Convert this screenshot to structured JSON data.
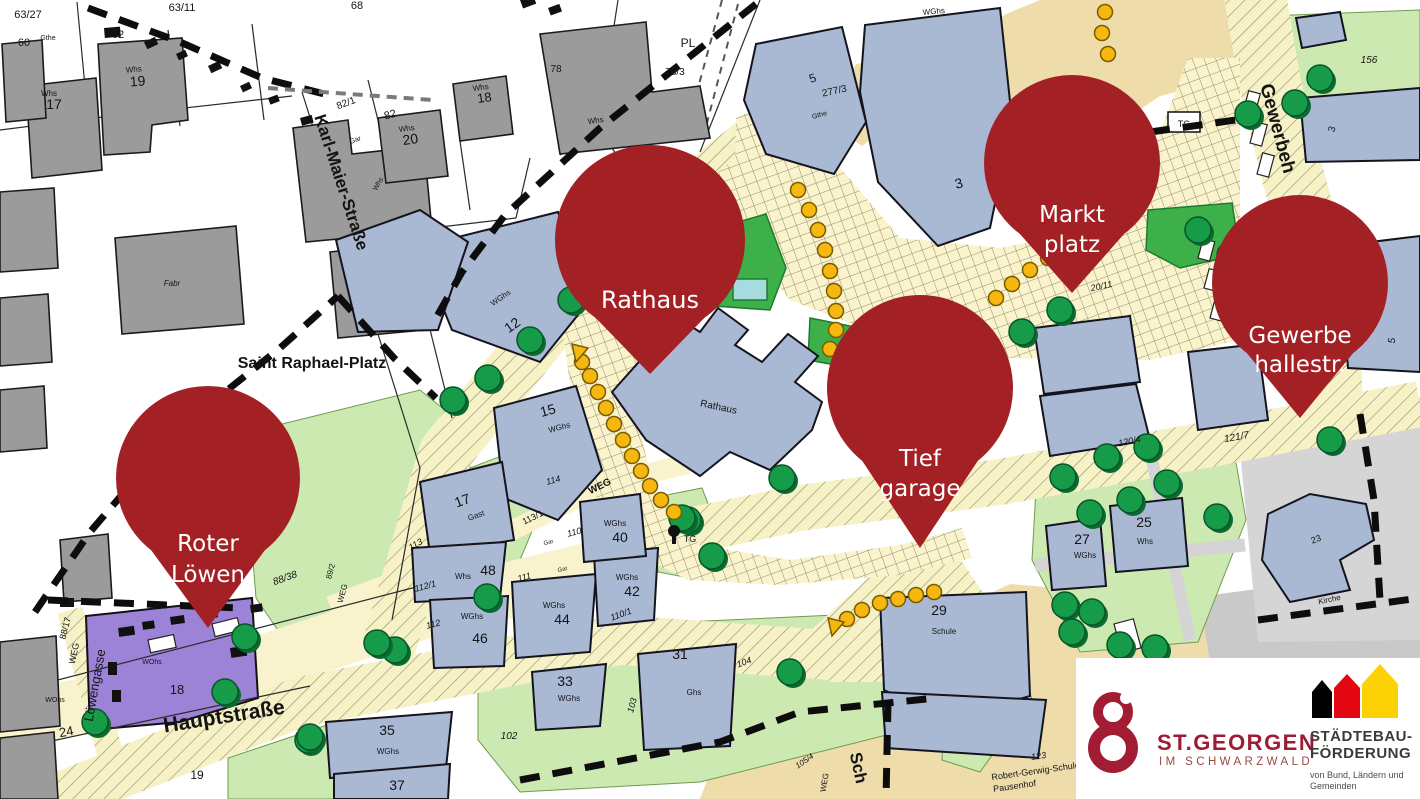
{
  "title": "Sanierungsgebiet Stadtmitte St. Georgen – Lageplan",
  "colors": {
    "pin_red": "#a32125",
    "building_blue": "#a9b8d3",
    "building_gray": "#9b9b9b",
    "street_yellow": "#f8f3cd",
    "plaza_beige": "#eedcab",
    "green_light": "#cde9b2",
    "green_bright": "#3db049",
    "tree_green": "#169c49",
    "dot_orange": "#f6b711",
    "parcel_purple": "#9c83d8",
    "logo_red": "#9c1c33",
    "house_black": "#000000",
    "house_red": "#e30613",
    "house_yellow": "#fdd205"
  },
  "pins": [
    {
      "id": "rathaus",
      "line1": "Rathaus",
      "line2": ""
    },
    {
      "id": "marktplatz",
      "line1": "Markt",
      "line2": "platz"
    },
    {
      "id": "tiefgarage",
      "line1": "Tief",
      "line2": "garage"
    },
    {
      "id": "gewerbehallestr",
      "line1": "Gewerbe",
      "line2": "hallestr."
    },
    {
      "id": "roter-loewen",
      "line1": "Roter",
      "line2": "Löwen"
    }
  ],
  "logos": {
    "st_georgen": {
      "title": "ST.GEORGEN",
      "subtitle": "IM SCHWARZWALD"
    },
    "staedtebaufoerderung": {
      "line1": "STÄDTEBAU-",
      "line2": "FÖRDERUNG",
      "tagline1": "von Bund, Ländern und",
      "tagline2": "Gemeinden"
    }
  },
  "map": {
    "labels": [
      [
        "63/27",
        28,
        18,
        0,
        11
      ],
      [
        "60",
        24,
        46,
        0,
        11
      ],
      [
        "Gthe",
        48,
        40,
        0,
        7
      ],
      [
        "62",
        118,
        38,
        0,
        11
      ],
      [
        "63/11",
        182,
        11,
        0,
        11
      ],
      [
        "68",
        357,
        9,
        0,
        11
      ],
      [
        "Whs",
        134,
        72,
        -5,
        8
      ],
      [
        "19",
        138,
        86,
        -5,
        14
      ],
      [
        "Whs",
        49,
        96,
        0,
        8
      ],
      [
        "17",
        54,
        109,
        0,
        14
      ],
      [
        "Whs",
        407,
        131,
        -8,
        8
      ],
      [
        "20",
        411,
        144,
        -8,
        14
      ],
      [
        "Whs",
        481,
        90,
        -8,
        8
      ],
      [
        "18",
        485,
        102,
        -8,
        13
      ],
      [
        "82/1",
        347,
        106,
        -20,
        10
      ],
      [
        "82",
        391,
        118,
        -15,
        11
      ],
      [
        "Gar",
        356,
        142,
        -20,
        7
      ],
      [
        "Whs",
        380,
        185,
        -60,
        7
      ],
      [
        "78",
        556,
        72,
        0,
        10
      ],
      [
        "PL",
        688,
        47,
        0,
        12
      ],
      [
        "78/3",
        675,
        75,
        0,
        10
      ],
      [
        "Fabr",
        172,
        286,
        0,
        8,
        "i"
      ],
      [
        "Saint Raphael-Platz",
        312,
        368,
        0,
        16,
        "b"
      ],
      [
        "Karl-Maier-Straße",
        336,
        184,
        72,
        17,
        "b"
      ],
      [
        "88/37",
        274,
        449,
        -35,
        10
      ],
      [
        "88/38",
        286,
        581,
        -20,
        10,
        "i"
      ],
      [
        "88/17",
        68,
        629,
        -75,
        9
      ],
      [
        "WEG",
        77,
        654,
        -78,
        9
      ],
      [
        "Löwengasse",
        99,
        686,
        -80,
        13
      ],
      [
        "WOhs",
        55,
        702,
        0,
        7
      ],
      [
        "24",
        67,
        736,
        -10,
        13
      ],
      [
        "WOhs",
        152,
        664,
        0,
        7
      ],
      [
        "18",
        177,
        694,
        0,
        13
      ],
      [
        "Hauptstraße",
        225,
        723,
        -9,
        21,
        "b"
      ],
      [
        "19",
        197,
        779,
        0,
        12
      ],
      [
        "89/2",
        333,
        572,
        -75,
        8
      ],
      [
        "WEG",
        345,
        594,
        -75,
        8
      ],
      [
        "WGhs",
        502,
        300,
        -35,
        8
      ],
      [
        "12",
        515,
        329,
        -35,
        14
      ],
      [
        "WGhs",
        560,
        430,
        -15,
        8
      ],
      [
        "15",
        549,
        415,
        -15,
        14
      ],
      [
        "114",
        554,
        483,
        -15,
        9,
        "i"
      ],
      [
        "WEG",
        601,
        489,
        -26,
        10,
        "b"
      ],
      [
        "113/1",
        534,
        520,
        -26,
        9
      ],
      [
        "110",
        575,
        535,
        -15,
        9,
        "i"
      ],
      [
        "Gar",
        549,
        544,
        -15,
        6
      ],
      [
        "Gar",
        563,
        571,
        -15,
        6
      ],
      [
        "111",
        525,
        580,
        -15,
        9,
        "i"
      ],
      [
        "113",
        417,
        547,
        -30,
        9,
        "i"
      ],
      [
        "112/1",
        426,
        589,
        -15,
        9,
        "i"
      ],
      [
        "112",
        434,
        627,
        -15,
        9,
        "i"
      ],
      [
        "Gast",
        477,
        518,
        -20,
        8
      ],
      [
        "17",
        464,
        505,
        -20,
        14
      ],
      [
        "Whs",
        463,
        579,
        0,
        8
      ],
      [
        "48",
        488,
        575,
        0,
        14
      ],
      [
        "WGhs",
        472,
        619,
        0,
        8
      ],
      [
        "46",
        480,
        643,
        0,
        14
      ],
      [
        "WGhs",
        554,
        608,
        0,
        8
      ],
      [
        "44",
        562,
        624,
        0,
        14
      ],
      [
        "WGhs",
        627,
        580,
        0,
        8
      ],
      [
        "42",
        632,
        596,
        0,
        14
      ],
      [
        "WGhs",
        615,
        526,
        0,
        8
      ],
      [
        "40",
        620,
        542,
        0,
        14
      ],
      [
        "110/1",
        622,
        617,
        -20,
        9,
        "i"
      ],
      [
        "WGhs",
        569,
        701,
        0,
        8
      ],
      [
        "33",
        565,
        686,
        0,
        14
      ],
      [
        "WGhs",
        388,
        754,
        0,
        8
      ],
      [
        "35",
        387,
        735,
        0,
        14
      ],
      [
        "37",
        397,
        790,
        0,
        14
      ],
      [
        "Ghs",
        694,
        695,
        0,
        8
      ],
      [
        "31",
        680,
        659,
        0,
        14
      ],
      [
        "102",
        509,
        739,
        0,
        10,
        "i"
      ],
      [
        "103",
        635,
        706,
        -75,
        9,
        "i"
      ],
      [
        "104",
        745,
        665,
        -20,
        9,
        "i"
      ],
      [
        "105/4",
        806,
        763,
        -35,
        8,
        "i"
      ],
      [
        "WEG",
        827,
        783,
        -80,
        8
      ],
      [
        "Sch",
        853,
        769,
        78,
        17,
        "b"
      ],
      [
        "Schule",
        944,
        634,
        0,
        8
      ],
      [
        "29",
        939,
        615,
        0,
        14
      ],
      [
        "123",
        1039,
        759,
        -8,
        9,
        "i"
      ],
      [
        "Robert-Gerwig-Schule",
        1036,
        774,
        -8,
        9
      ],
      [
        "Pausenhof",
        1015,
        789,
        -8,
        9
      ],
      [
        "WGhs",
        1085,
        558,
        0,
        8
      ],
      [
        "27",
        1082,
        544,
        0,
        14
      ],
      [
        "Whs",
        1145,
        544,
        0,
        8
      ],
      [
        "25",
        1144,
        527,
        0,
        14
      ],
      [
        "23",
        1317,
        542,
        -20,
        9
      ],
      [
        "Kirche",
        1330,
        602,
        -12,
        8
      ],
      [
        "121/7",
        1237,
        440,
        -10,
        10,
        "i"
      ],
      [
        "120/4",
        1130,
        444,
        -12,
        9,
        "i"
      ],
      [
        "20/11",
        1102,
        289,
        -12,
        9,
        "i"
      ],
      [
        "TG",
        1184,
        127,
        0,
        9
      ],
      [
        "TG",
        690,
        542,
        0,
        9
      ],
      [
        "WGhs",
        934,
        14,
        -5,
        8
      ],
      [
        "3",
        960,
        188,
        -15,
        14
      ],
      [
        "5",
        814,
        82,
        -20,
        12
      ],
      [
        "277/3",
        835,
        94,
        -12,
        10
      ],
      [
        "Gthe",
        820,
        117,
        -15,
        7
      ],
      [
        "156",
        1369,
        63,
        0,
        10,
        "i"
      ],
      [
        "3",
        1335,
        130,
        -75,
        10
      ],
      [
        "Gewerbeh",
        1272,
        130,
        75,
        19,
        "b"
      ],
      [
        "5",
        1395,
        341,
        -80,
        10
      ],
      [
        "Whs",
        596,
        123,
        -8,
        8
      ],
      [
        "Rathaus",
        718,
        410,
        12,
        10
      ]
    ]
  }
}
